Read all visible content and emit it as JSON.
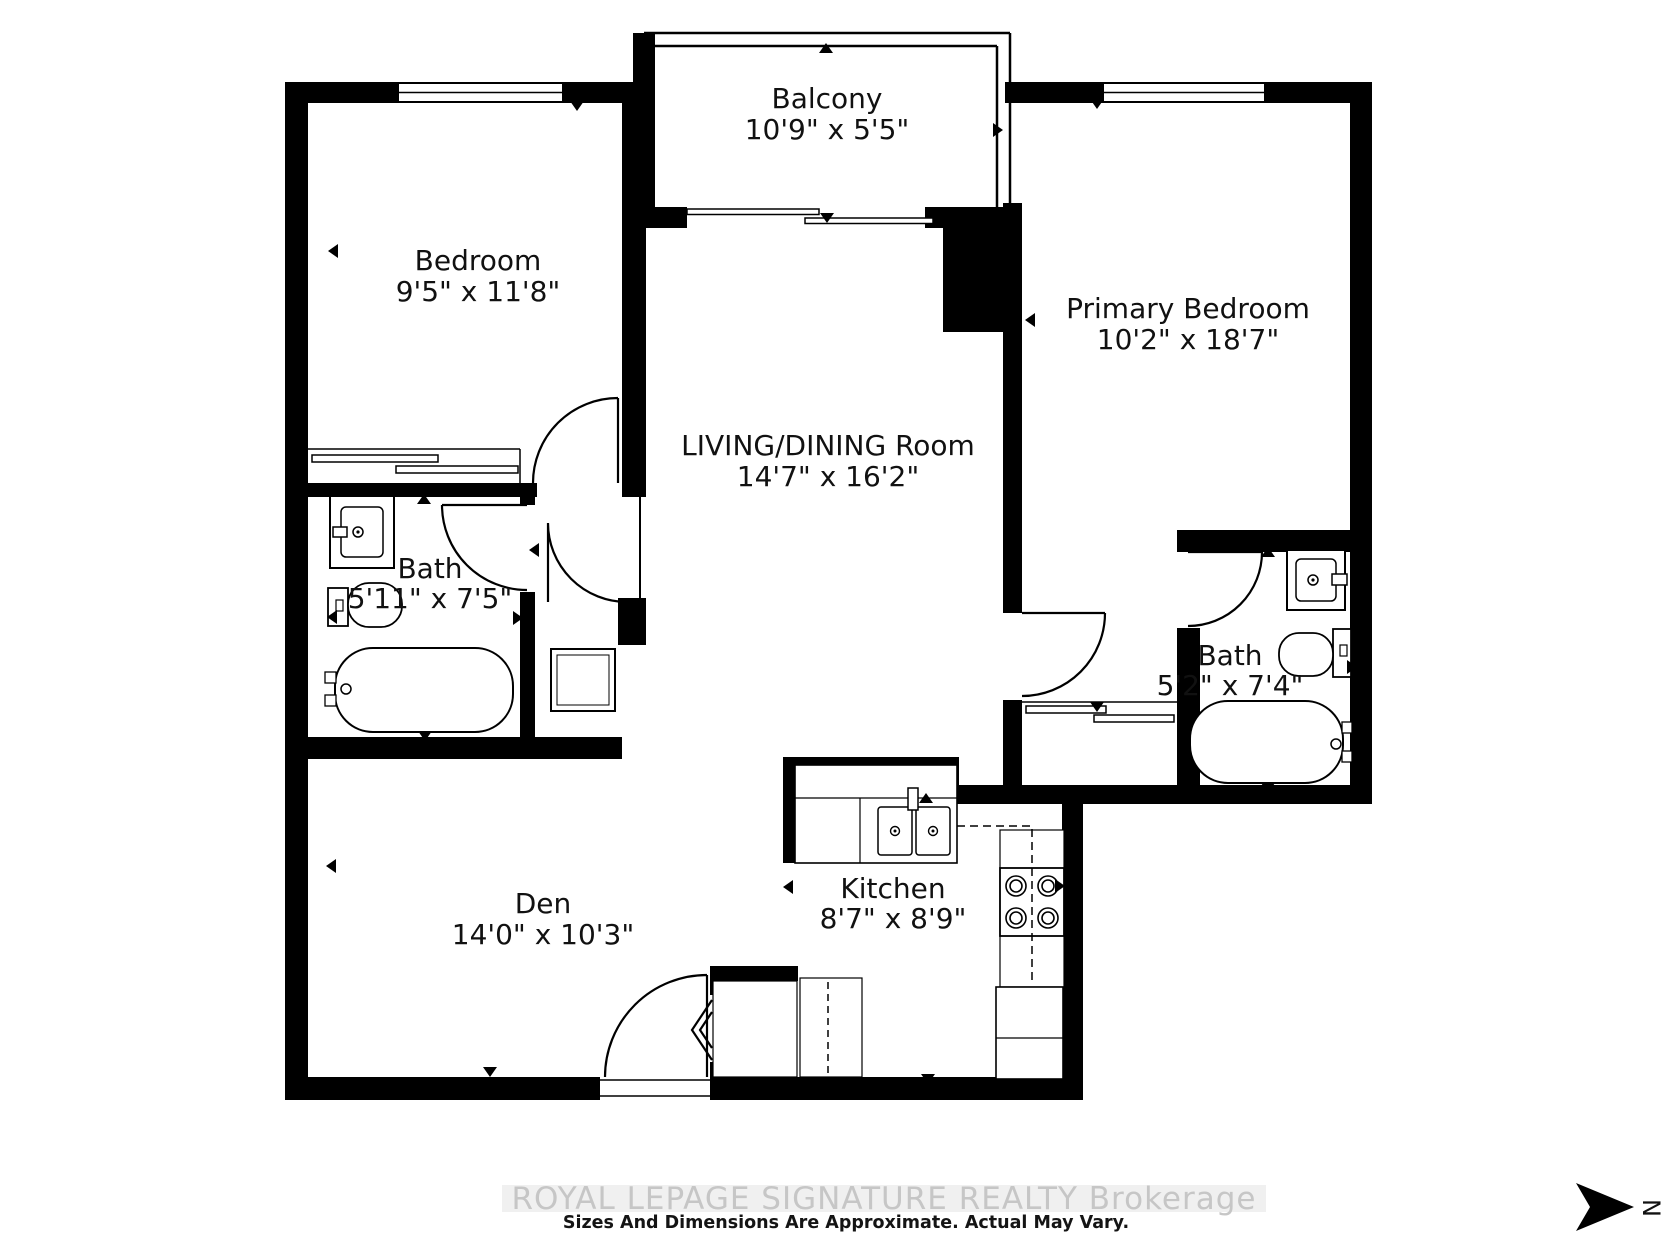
{
  "plan": {
    "rooms": [
      {
        "id": "balcony",
        "name": "Balcony",
        "dims": "10'9\" x 5'5\""
      },
      {
        "id": "bedroom",
        "name": "Bedroom",
        "dims": "9'5\" x 11'8\""
      },
      {
        "id": "primary-bedroom",
        "name": "Primary Bedroom",
        "dims": "10'2\" x 18'7\""
      },
      {
        "id": "living-dining",
        "name": "LIVING/DINING Room",
        "dims": "14'7\" x 16'2\""
      },
      {
        "id": "bath-left",
        "name": "Bath",
        "dims": "5'11\" x 7'5\""
      },
      {
        "id": "bath-ensuite",
        "name": "Bath",
        "dims": "5'2\" x 7'4\""
      },
      {
        "id": "den",
        "name": "Den",
        "dims": "14'0\" x 10'3\""
      },
      {
        "id": "kitchen",
        "name": "Kitchen",
        "dims": "8'7\" x 8'9\""
      }
    ],
    "compass": {
      "north_label": "N"
    }
  },
  "footer": {
    "watermark": "ROYAL LEPAGE SIGNATURE REALTY  Brokerage",
    "disclaimer": "Sizes And Dimensions Are Approximate. Actual May Vary."
  },
  "colors": {
    "wall": "#000000",
    "background": "#ffffff",
    "watermark_text": "#c6c6c6"
  }
}
